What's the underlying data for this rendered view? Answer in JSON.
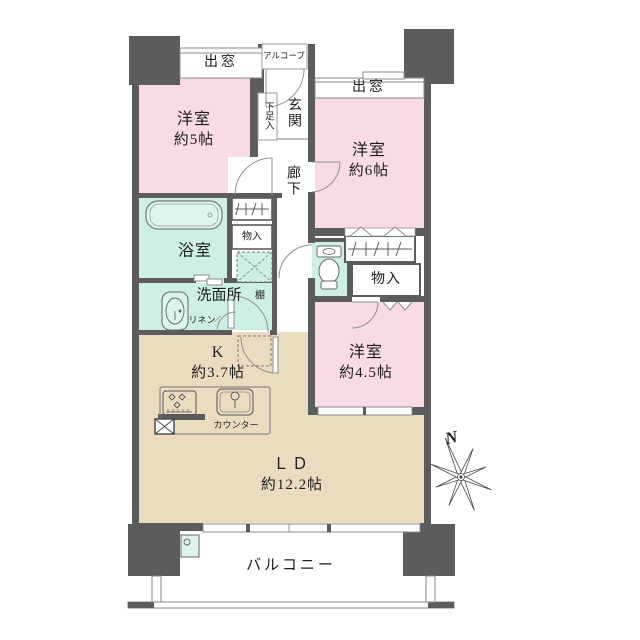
{
  "floorplan": {
    "labels": {
      "bay_window_left": "出窓",
      "bay_window_right": "出窓",
      "alcove": "アルコーブ",
      "shoe_cabinet": "下足入",
      "entrance": "玄関",
      "hallway": "廊下",
      "bedroom_5": {
        "name": "洋室",
        "size": "約5帖"
      },
      "bedroom_6": {
        "name": "洋室",
        "size": "約6帖"
      },
      "bedroom_45": {
        "name": "洋室",
        "size": "約4.5帖"
      },
      "bathroom": "浴室",
      "washroom": "洗面所",
      "linen": "リネン",
      "shelf": "棚",
      "closet_hall": "物入",
      "closet_right": "物入",
      "kitchen": {
        "name": "K",
        "size": "約3.7帖"
      },
      "counter": "カウンター",
      "living_dining": {
        "name": "ＬＤ",
        "size": "約12.2帖"
      },
      "balcony": "バルコニー",
      "compass_north": "N"
    },
    "colors": {
      "wall": "#5d5c5c",
      "bedroom_fill": "#f9dbe5",
      "wet_area_fill": "#cdf0e2",
      "living_fill": "#ebdcc0",
      "line": "#8a8a8a"
    }
  }
}
